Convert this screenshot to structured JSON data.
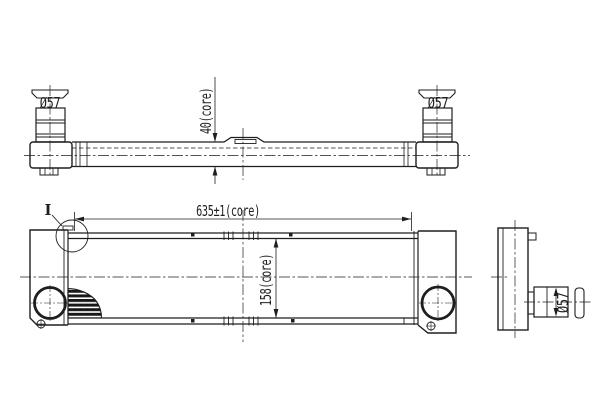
{
  "drawing": {
    "type": "technical-engineering-drawing",
    "subject": "intercooler-three-view",
    "background_color": "#ffffff",
    "line_color": "#1e1e1e",
    "labels": {
      "detail_marker": "I",
      "dim_core_width": "635±1(core)",
      "dim_core_height": "158(core)",
      "dim_core_depth": "40(core)",
      "dia_left_port": "Ø57",
      "dia_right_port": "Ø57",
      "dia_side_port": "Ø57"
    }
  }
}
